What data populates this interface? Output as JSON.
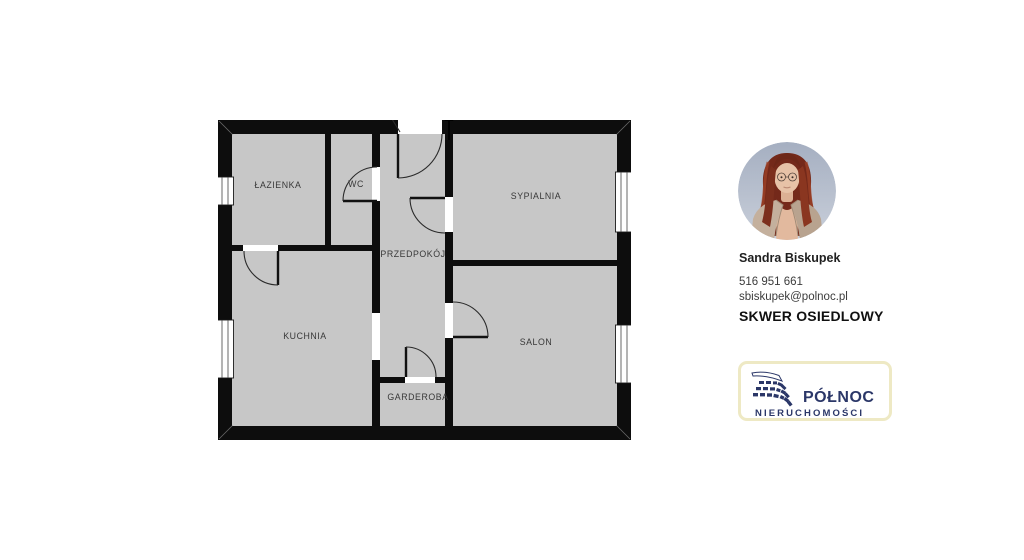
{
  "floor_plan": {
    "rooms": [
      {
        "id": "lazienka",
        "label": "ŁAZIENKA"
      },
      {
        "id": "wc",
        "label": "WC"
      },
      {
        "id": "sypialnia",
        "label": "SYPIALNIA"
      },
      {
        "id": "przedpokoj",
        "label": "PRZEDPOKÓJ"
      },
      {
        "id": "kuchnia",
        "label": "KUCHNIA"
      },
      {
        "id": "salon",
        "label": "SALON"
      },
      {
        "id": "garderoba",
        "label": "GARDEROBA"
      }
    ],
    "colors": {
      "wall": "#0d0d0d",
      "room_fill": "#c7c7c7",
      "label_text": "#383838"
    }
  },
  "agent": {
    "name": "Sandra Biskupek",
    "phone": "516 951 661",
    "email": "sbiskupek@polnoc.pl",
    "listing_title": "SKWER OSIEDLOWY"
  },
  "logo": {
    "brand": "PÓŁNOC",
    "subtitle": "NIERUCHOMOŚCI",
    "colors": {
      "navy": "#2b3768",
      "border": "#eee9c4"
    }
  }
}
